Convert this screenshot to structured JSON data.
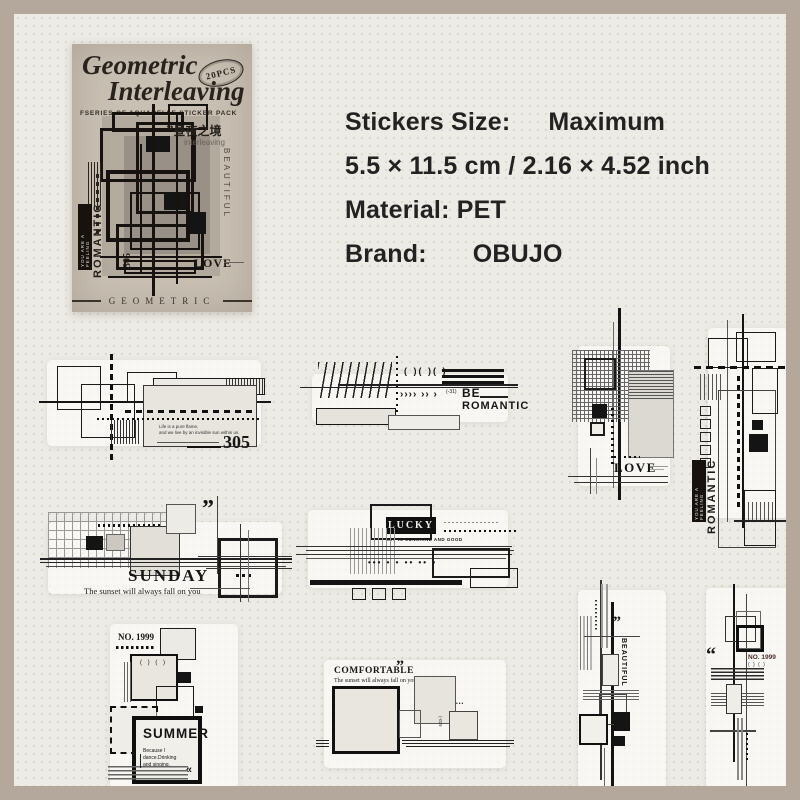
{
  "colors": {
    "frame": "#b4a79c",
    "background": "#edebe5",
    "ink": "#1a1a1a",
    "package_paper": "#c9c0b4"
  },
  "package": {
    "title1": "Geometric",
    "title2": "Interleaving",
    "badge": "20PCS",
    "subtitle": "FSERIES OF AQUARELLE STICKER PACK",
    "cn_quote": "”",
    "cn": "昼夜之境",
    "interleaving": "interleaving",
    "beautiful": "BEAUTIFUL",
    "love": "LOVE",
    "num": "305",
    "romantic": "ROMANTIC",
    "you_are": "YOU ARE A FEELING",
    "footer": "GEOMETRIC"
  },
  "info": {
    "size_label": "Stickers Size:",
    "size_value": "Maximum",
    "dims": "5.5 × 11.5 cm / 2.16 × 4.52 inch",
    "material_label": "Material:",
    "material_value": "PET",
    "brand_label": "Brand:",
    "brand_value": "OBUJO"
  },
  "stickers": {
    "s305": {
      "num": "305",
      "micro1": "Life is a pure flame,",
      "micro2": "and we live by an invisible sun within us."
    },
    "be_romantic": {
      "brackets": "( )( )( )",
      "arrows": "›››› ›› ›",
      "tag": "(-31)",
      "be": "BE",
      "romantic": "ROMANTIC"
    },
    "love": {
      "word": "LOVE"
    },
    "romantic_v": {
      "word": "ROMANTIC",
      "label": "YOU ARE A FEELING"
    },
    "sunday": {
      "word": "SUNDAY",
      "sub": "The sunset will always fall on you",
      "quote": "”"
    },
    "lucky": {
      "word": "LUCKY",
      "sub": "LET IN SUNSHINE AND GOOD",
      "dots": "••• • • •• •• •"
    },
    "summer": {
      "no": "NO. 1999",
      "brackets": "( ) ( )",
      "word": "SUMMER",
      "line1": "Because I",
      "line2": "dance.Drinking",
      "line3": "and singing.",
      "arrows": "«"
    },
    "comfortable": {
      "word": "COMFORTABLE",
      "quote": "”",
      "sub": "The sunset will always fall on you",
      "dots": "•••",
      "side": "(-029"
    },
    "beautiful": {
      "word": "BEAUTIFUL",
      "quote": "”"
    },
    "no1999": {
      "no": "NO. 1999",
      "brackets": "( ) ( )",
      "quote": "“"
    }
  }
}
